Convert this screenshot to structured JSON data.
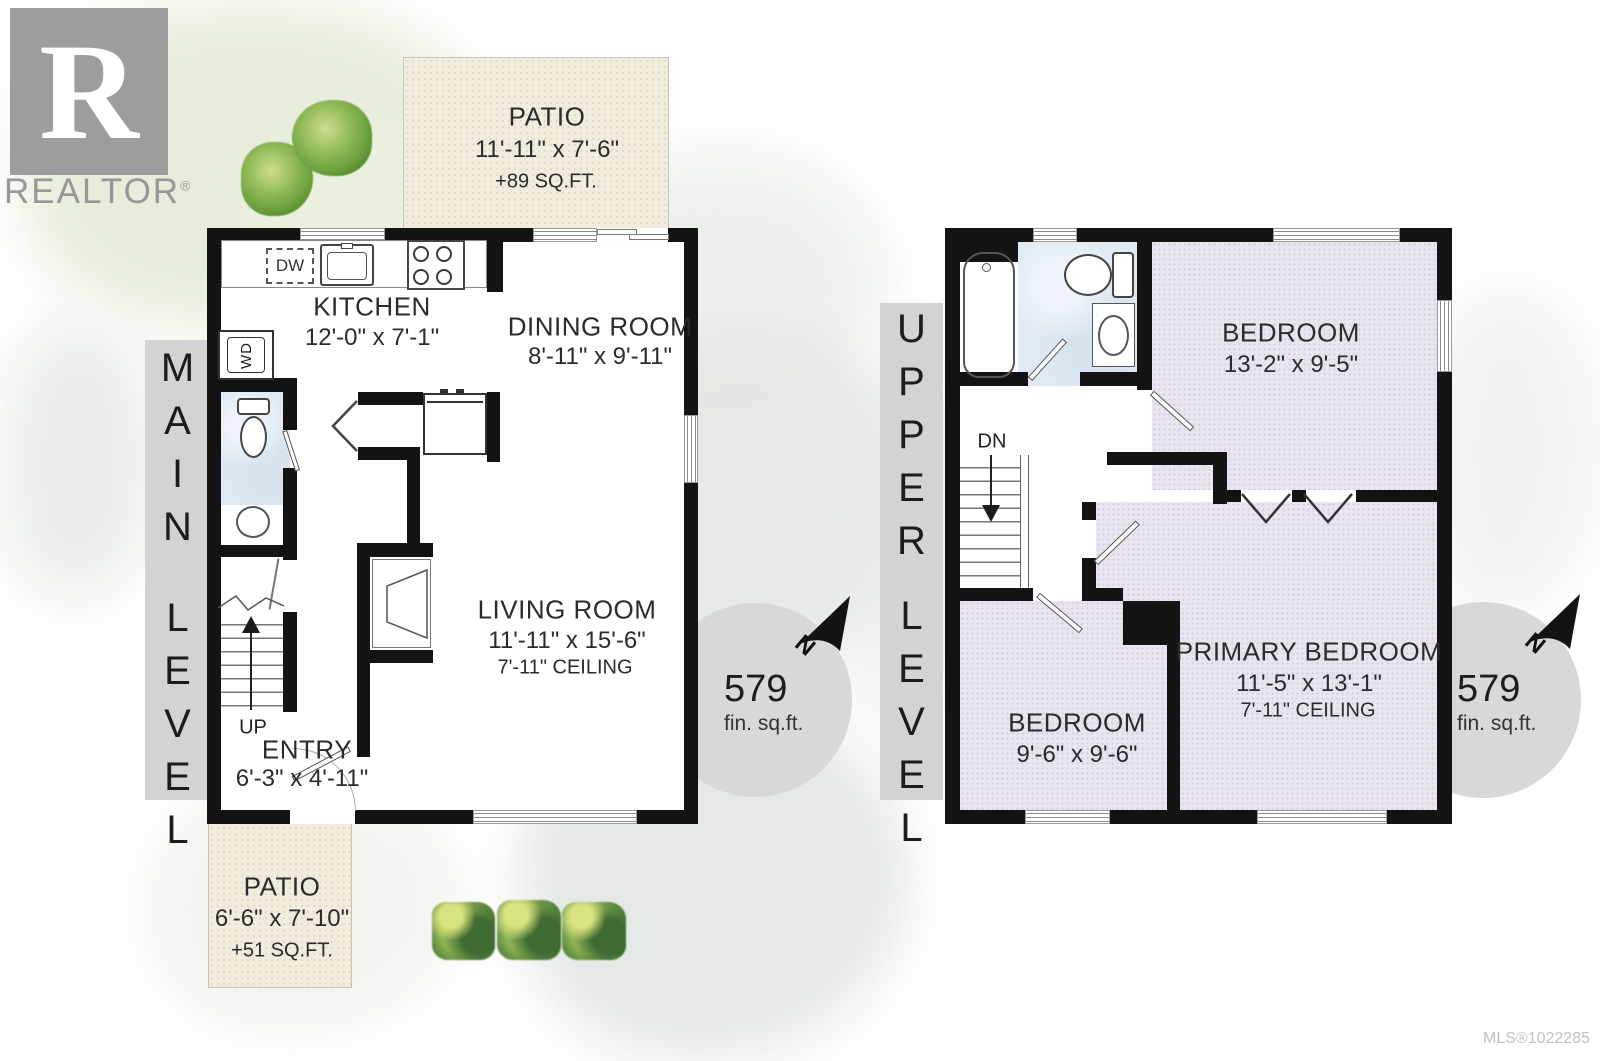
{
  "branding": {
    "logo_letter": "R",
    "logo_text": "REALTOR",
    "registered_mark": "®"
  },
  "footer": {
    "mls": "MLS®1022285"
  },
  "main_level": {
    "bar": {
      "word1": "MAIN",
      "word2": "LEVEL"
    },
    "area_badge": {
      "value": "579",
      "unit": "fin. sq.ft.",
      "north": "N"
    },
    "stairs_label": "UP",
    "appliances": {
      "dishwasher": "DW",
      "washer_dryer": "WD"
    },
    "rooms": {
      "patio_top": {
        "name": "PATIO",
        "dims": "11'-11\" x 7'-6\"",
        "area": "+89 SQ.FT."
      },
      "kitchen": {
        "name": "KITCHEN",
        "dims": "12'-0\" x 7'-1\""
      },
      "dining_room": {
        "name": "DINING ROOM",
        "dims": "8'-11\" x 9'-11\""
      },
      "living_room": {
        "name": "LIVING ROOM",
        "dims": "11'-11\" x 15'-6\"",
        "ceiling": "7'-11\" CEILING"
      },
      "entry": {
        "name": "ENTRY",
        "dims": "6'-3\" x 4'-11\""
      },
      "patio_bottom": {
        "name": "PATIO",
        "dims": "6'-6\" x 7'-10\"",
        "area": "+51 SQ.FT."
      }
    }
  },
  "upper_level": {
    "bar": {
      "word1": "UPPER",
      "word2": "LEVEL"
    },
    "area_badge": {
      "value": "579",
      "unit": "fin. sq.ft.",
      "north": "N"
    },
    "stairs_label": "DN",
    "rooms": {
      "bedroom_top": {
        "name": "BEDROOM",
        "dims": "13'-2\" x 9'-5\""
      },
      "bedroom_left": {
        "name": "BEDROOM",
        "dims": "9'-6\" x 9'-6\""
      },
      "primary_bedroom": {
        "name": "PRIMARY BEDROOM",
        "dims": "11'-5\" x 13'-1\"",
        "ceiling": "7'-11\" CEILING"
      }
    }
  },
  "colors": {
    "wall": "#131313",
    "patio_floor": "#f1ecdd",
    "bedroom_floor": "#eae4ef",
    "bath_floor": "#e0eaf4",
    "level_bar": "#d3d3d3",
    "area_circle": "#d8d8d8",
    "logo_grey": "#9d9d9d",
    "tree_green": "#6fa33f"
  }
}
